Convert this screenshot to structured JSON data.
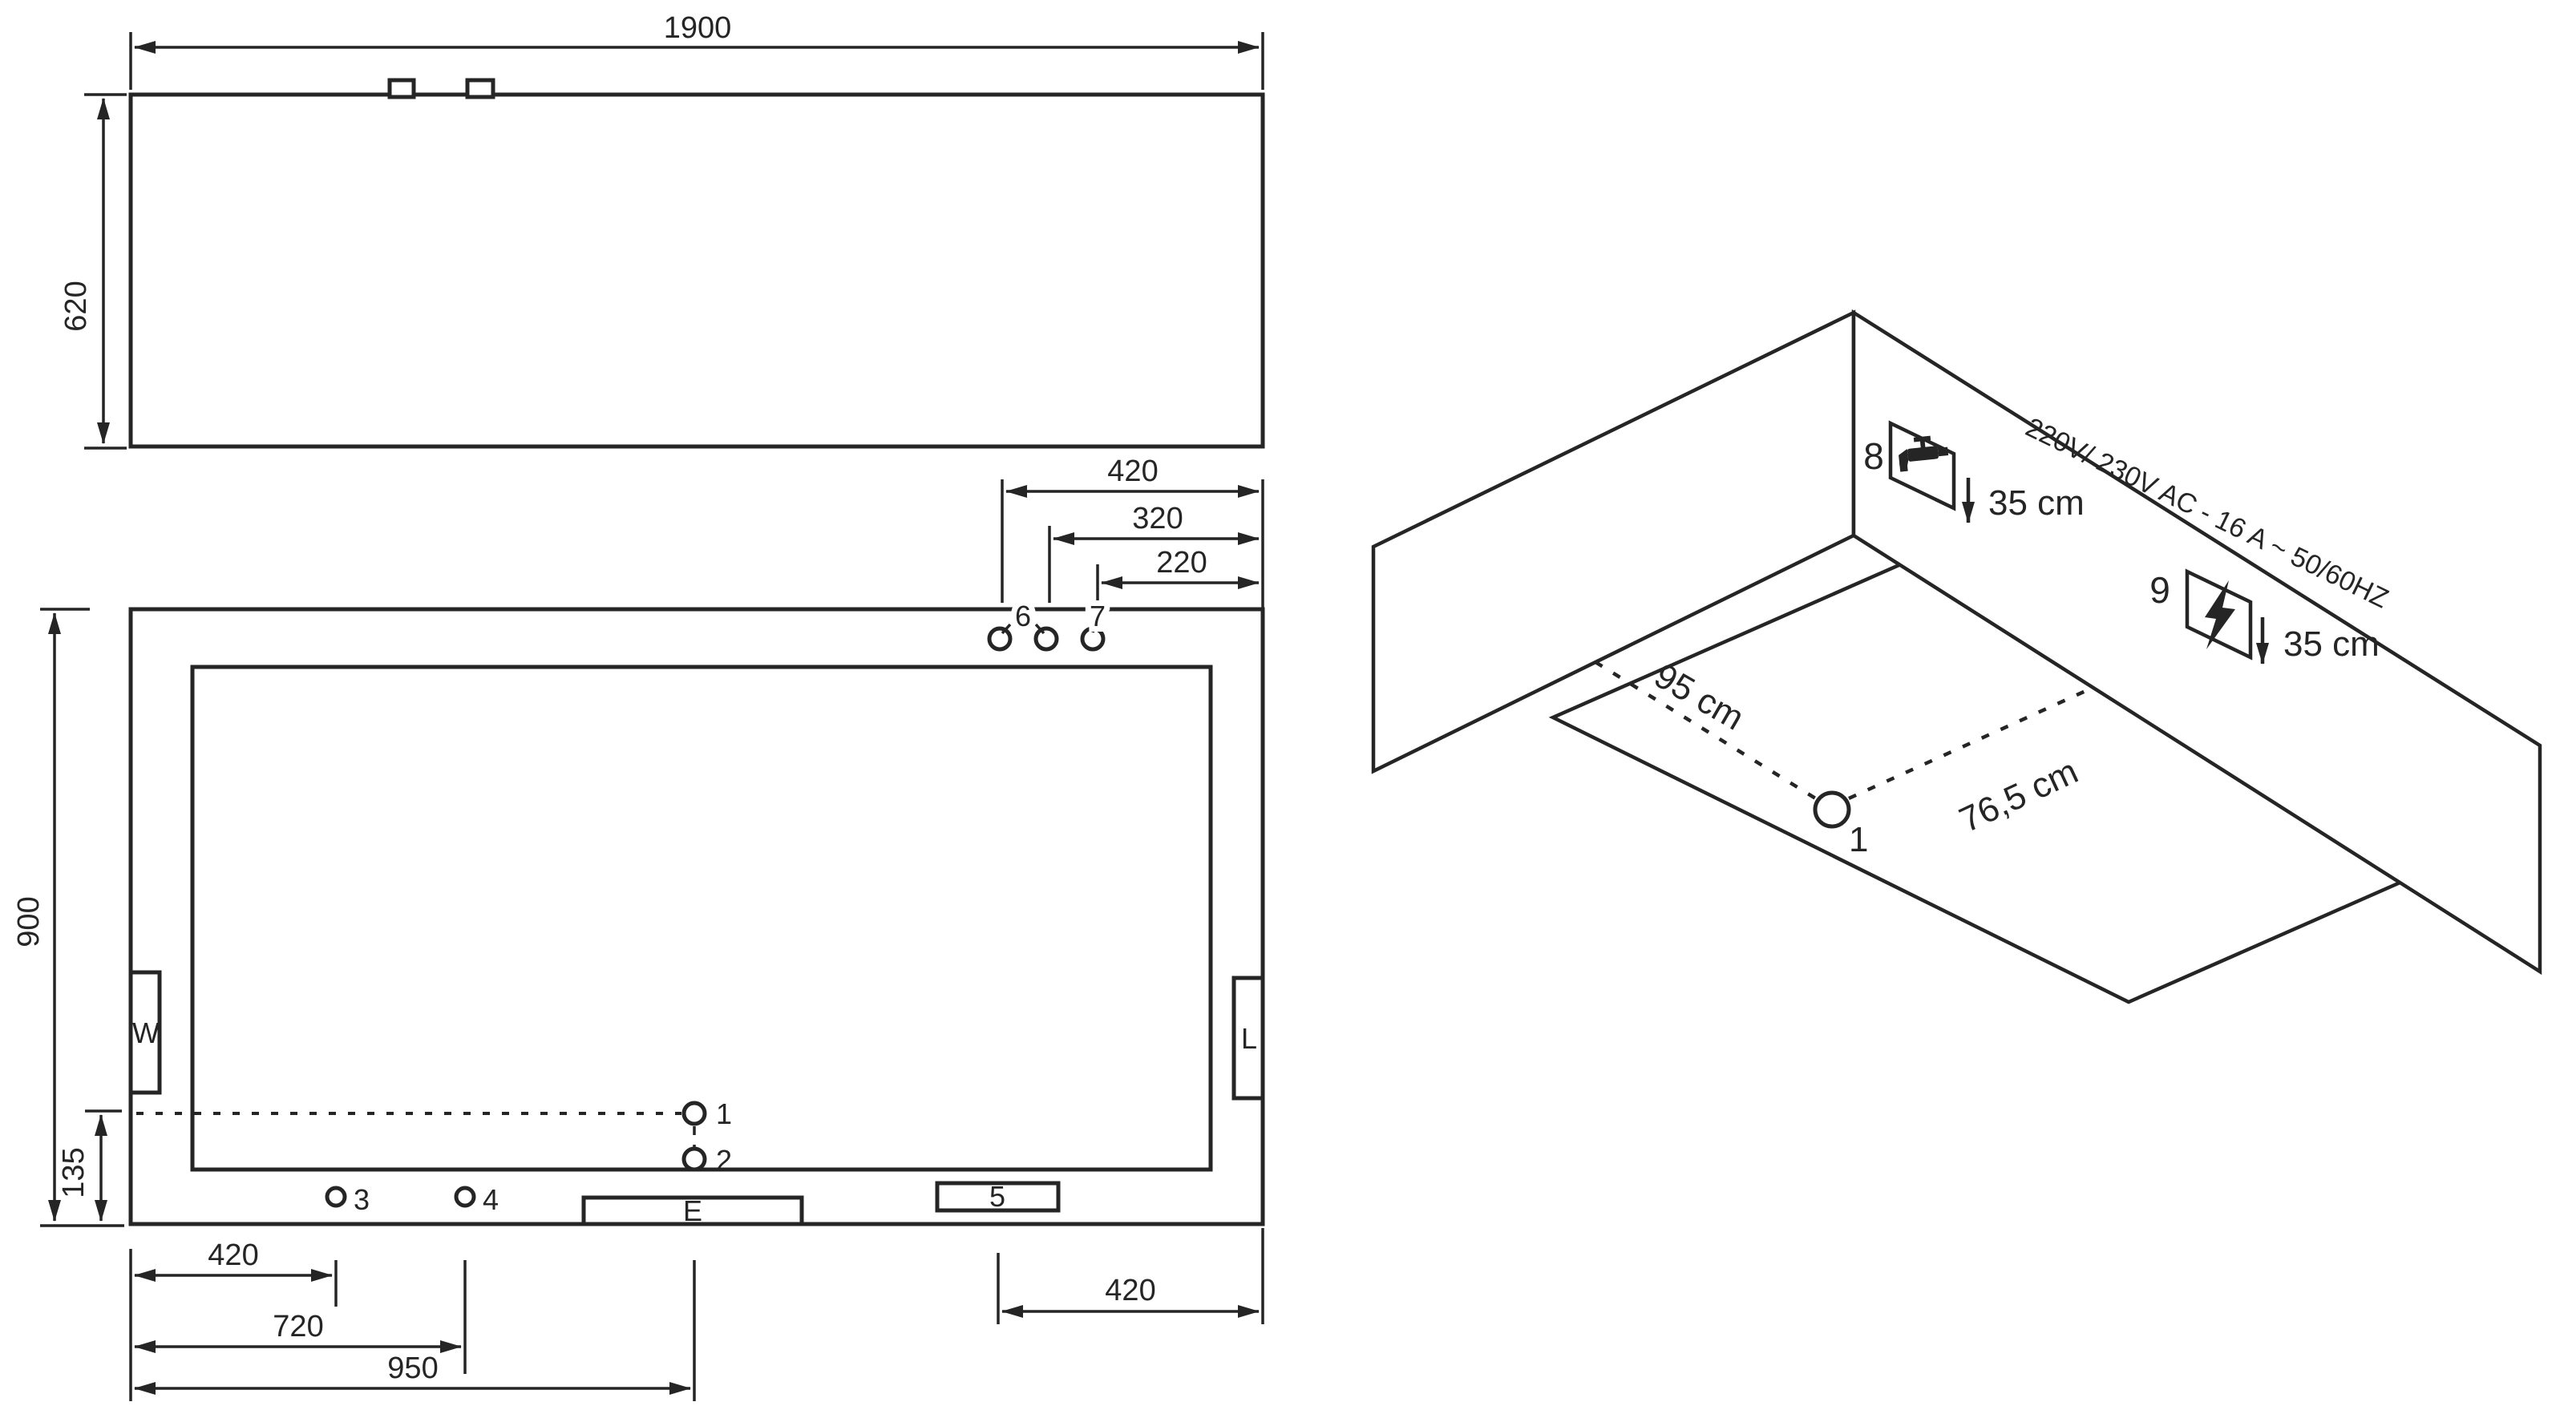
{
  "title": "appliance-installation-diagram",
  "front_view": {
    "dim_width": "1900",
    "dim_height": "620"
  },
  "plan_view": {
    "dim_top_1": "420",
    "dim_top_2": "320",
    "dim_top_3": "220",
    "dim_left_height": "900",
    "dim_left_offset": "135",
    "dim_bot_1": "420",
    "dim_bot_2": "720",
    "dim_bot_3": "950",
    "dim_bot_right": "420",
    "box_w": "W",
    "box_l": "L",
    "box_e": "E",
    "box_5": "5",
    "hole_1": "1",
    "hole_2": "2",
    "hole_3": "3",
    "hole_4": "4",
    "hole_6": "6",
    "hole_7": "7"
  },
  "iso_view": {
    "hole_1": "1",
    "label_8": "8",
    "label_9": "9",
    "dist_left_wall": "95 cm",
    "dist_right_wall": "76,5 cm",
    "drop_8": "35 cm",
    "drop_9": "35 cm",
    "power_rating": "220V/ 230V AC - 16 A ~ 50/60HZ",
    "icon_8": "faucet-icon",
    "icon_9": "lightning-icon"
  },
  "colors": {
    "line": "#252525",
    "background": "#ffffff"
  }
}
